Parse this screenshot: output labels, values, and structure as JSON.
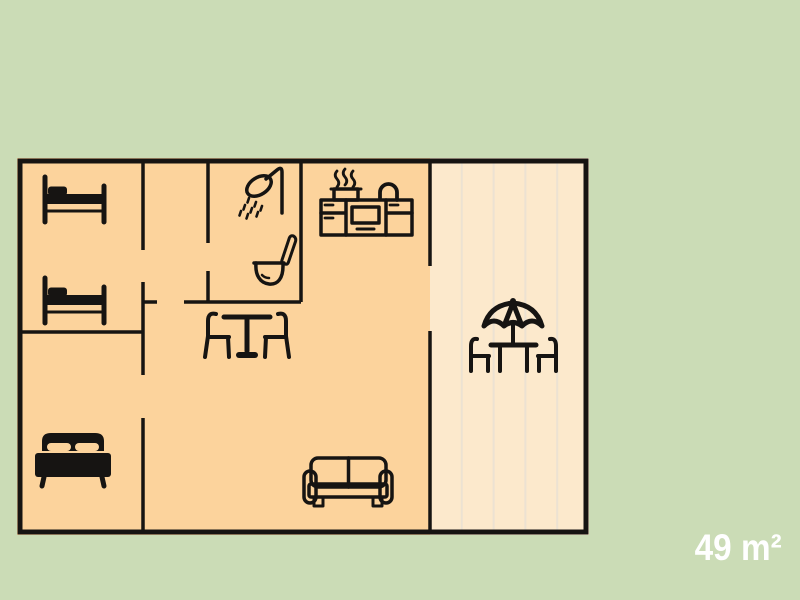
{
  "title": "Parkchalet | 4 pers",
  "area_label": "49 m²",
  "colors": {
    "background": "#cbdcb6",
    "floor": "#fcd39c",
    "terrace": "#fce9cc",
    "wall": "#161412",
    "title_text": "#1d1d1b",
    "area_text": "#ffffff",
    "plank_line": "#ece2d2"
  },
  "floorplan": {
    "icons": [
      "single-bed-icon",
      "single-bed-icon",
      "double-bed-icon",
      "shower-icon",
      "toilet-icon",
      "kitchen-icon",
      "dining-table-chairs-icon",
      "sofa-icon",
      "patio-table-umbrella-icon"
    ]
  }
}
